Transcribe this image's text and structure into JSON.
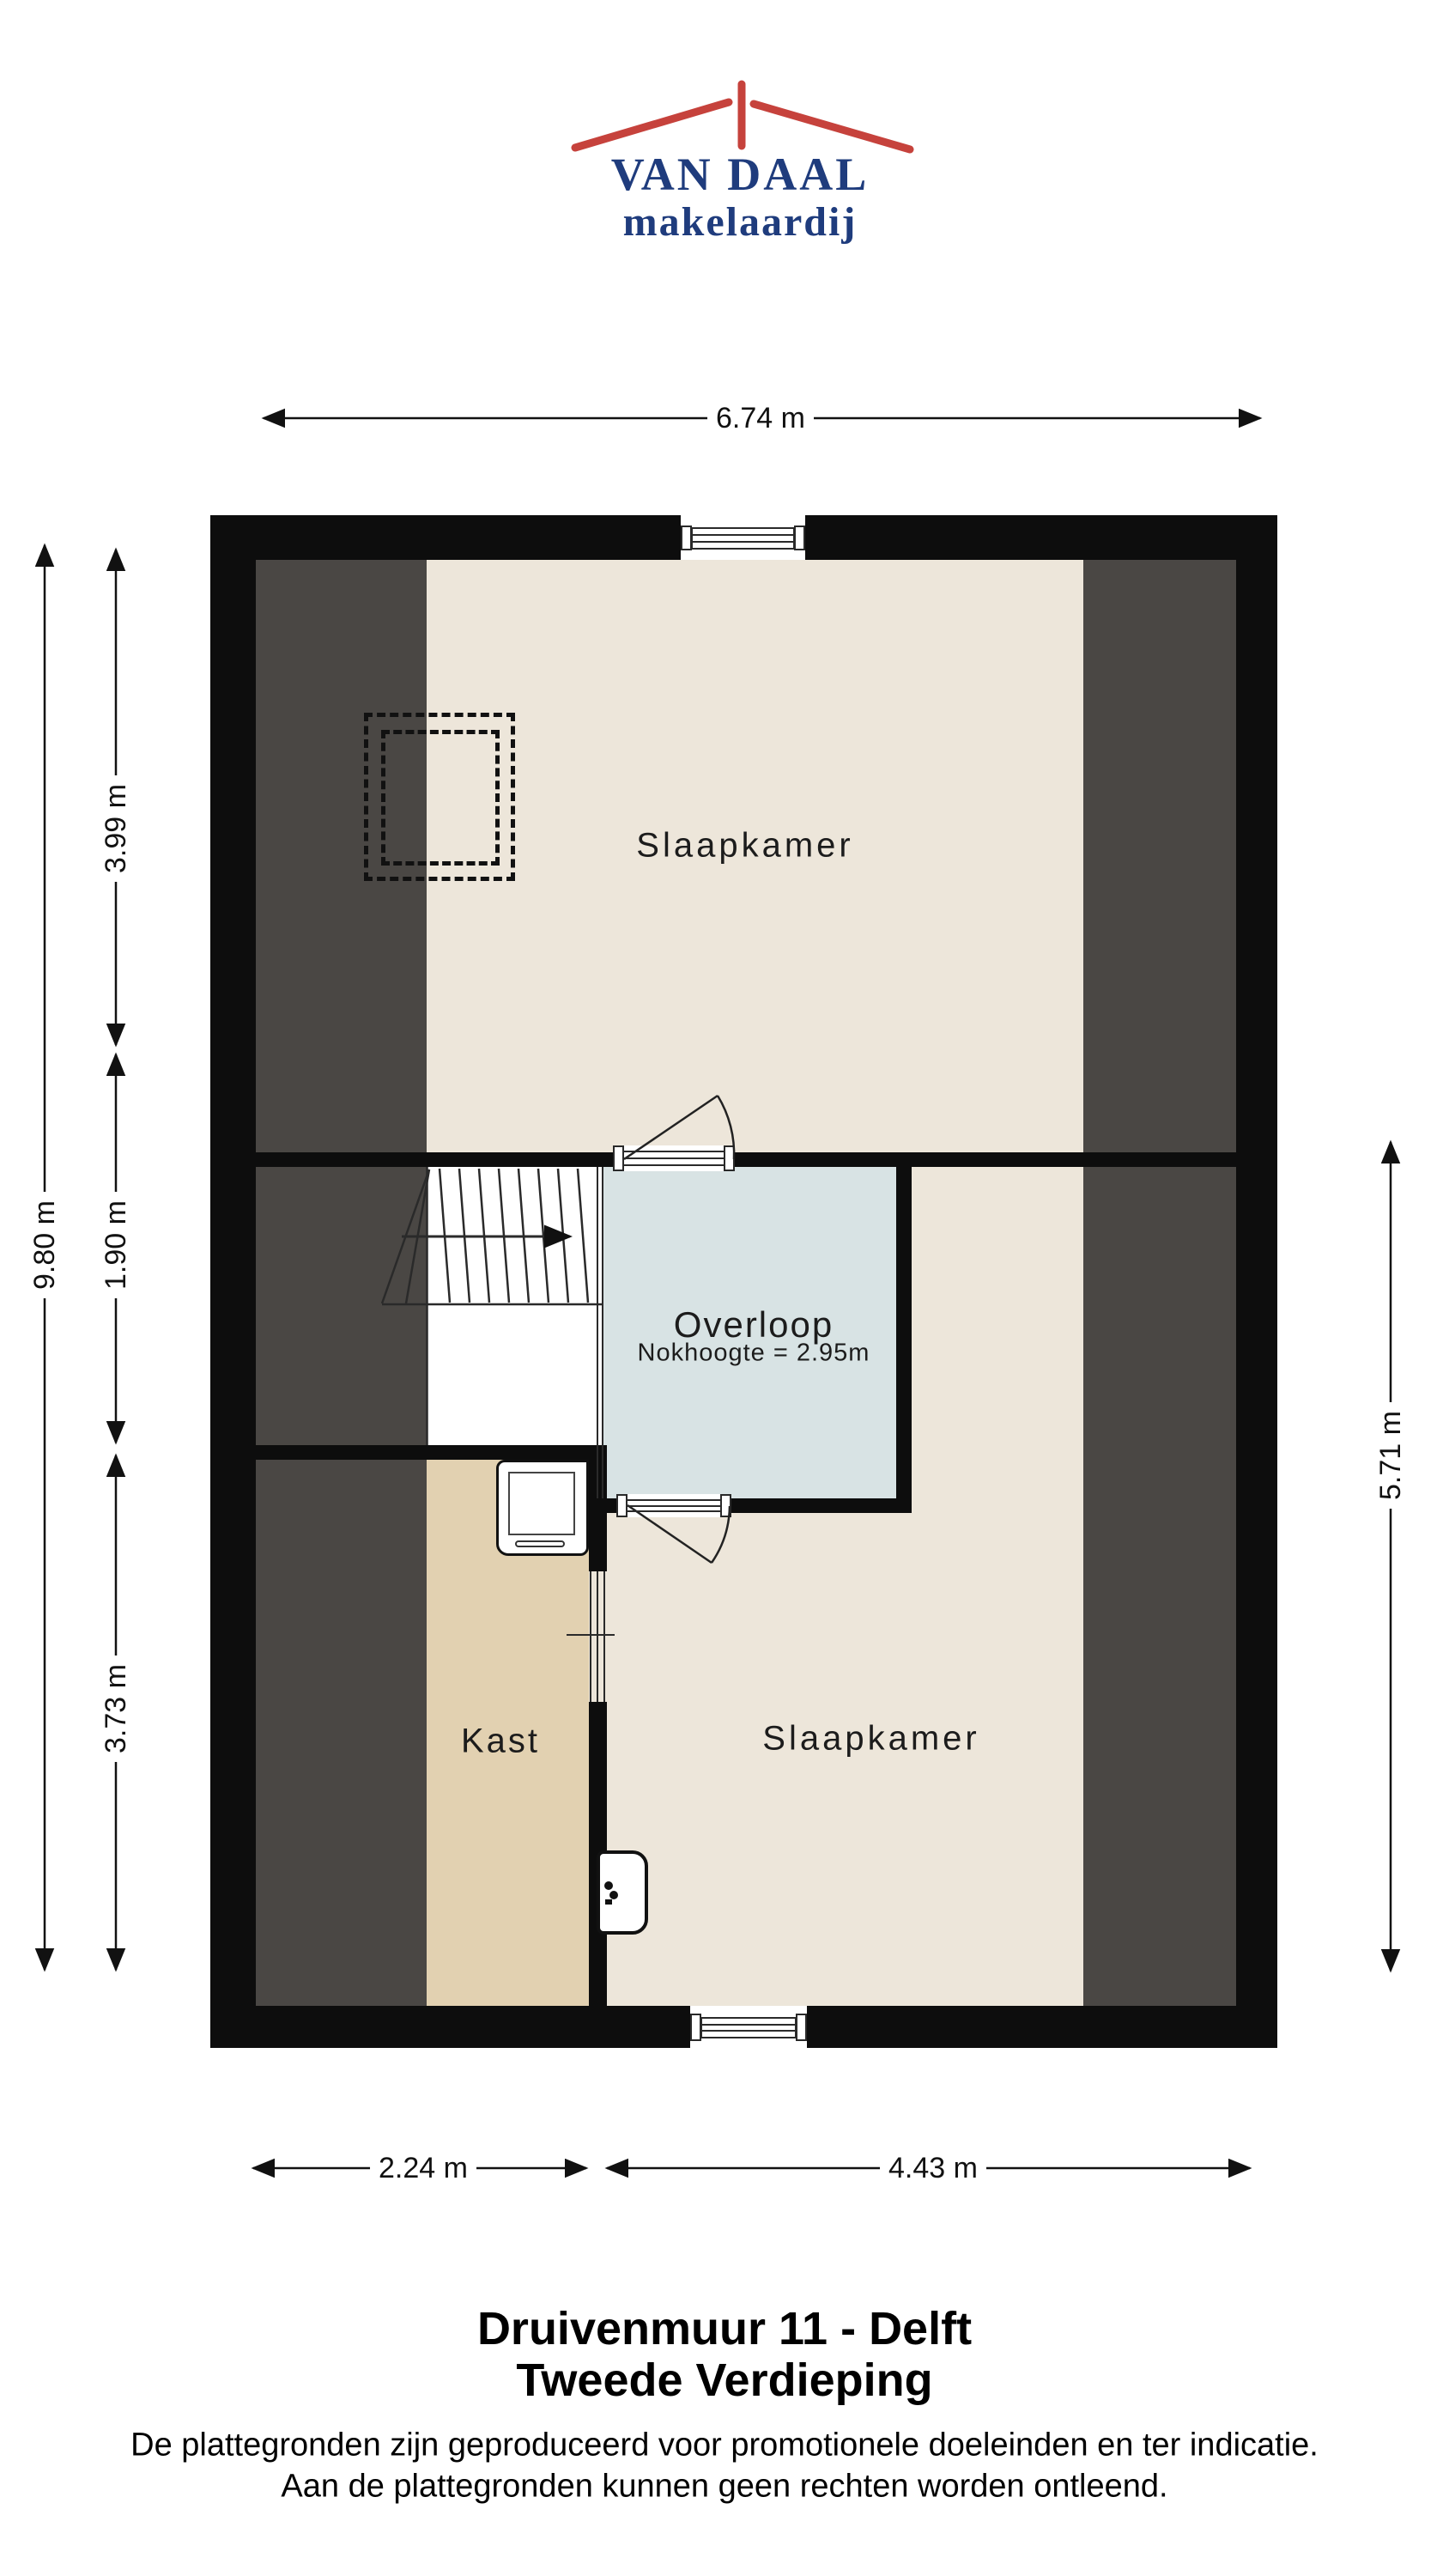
{
  "logo": {
    "name": "VAN DAAL",
    "subtitle": "makelaardij"
  },
  "dimensions": {
    "top_width": "6.74 m",
    "left_total": "9.80 m",
    "left_top": "3.99 m",
    "left_middle": "1.90 m",
    "left_bottom": "3.73 m",
    "right_height": "5.71 m",
    "bottom_left": "2.24 m",
    "bottom_right": "4.43 m"
  },
  "rooms": {
    "bedroom_top": "Slaapkamer",
    "landing": "Overloop",
    "landing_note": "Nokhoogte = 2.95m",
    "closet": "Kast",
    "bedroom_bottom": "Slaapkamer"
  },
  "footer": {
    "title_line1": "Druivenmuur 11 - Delft",
    "title_line2": "Tweede Verdieping",
    "disclaimer_line1": "De plattegronden zijn geproduceerd voor promotionele doeleinden en ter indicatie.",
    "disclaimer_line2": "Aan de plattegronden kunnen geen rechten worden ontleend."
  },
  "colors": {
    "wall": "#0d0d0d",
    "cream": "#ede6da",
    "tan": "#e2d1b1",
    "blue": "#d8e3e4",
    "dark": "#4a4744",
    "navy": "#1f3c7d",
    "red": "#c6423c"
  }
}
